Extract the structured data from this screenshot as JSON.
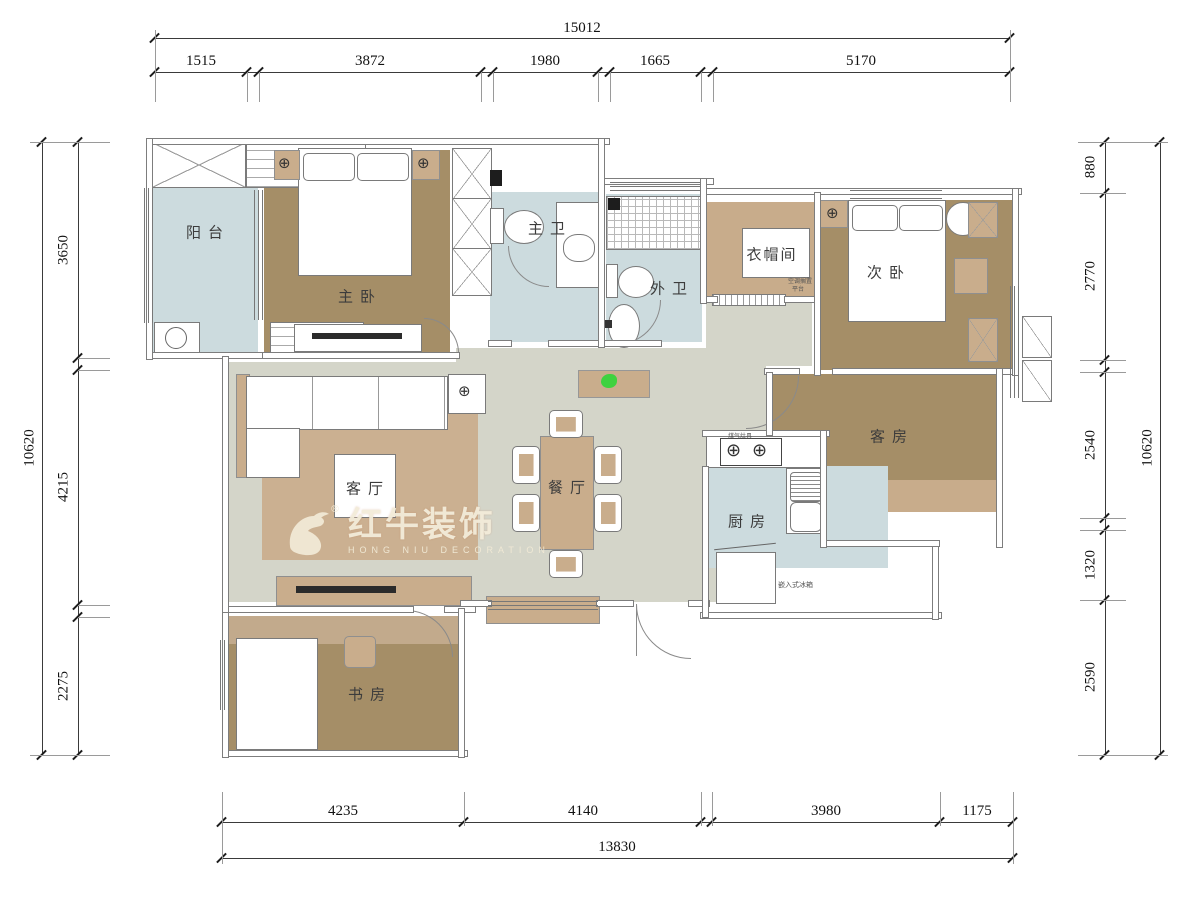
{
  "rooms": {
    "balcony": "阳台",
    "master_bedroom": "主卧",
    "master_bath": "主卫",
    "guest_bath": "外卫",
    "cloakroom": "衣帽间",
    "second_bedroom": "次卧",
    "living": "客厅",
    "dining": "餐厅",
    "guest_room": "客房",
    "kitchen": "厨房",
    "study": "书房"
  },
  "annotations": {
    "stove": "煤气灶具",
    "fridge": "嵌入式冰箱",
    "ac_shelf_line1": "空调搁置",
    "ac_shelf_line2": "平台"
  },
  "icons": {
    "target": "⊕",
    "registered": "®"
  },
  "dimensions": {
    "top": {
      "overall": "15012",
      "segments": [
        "1515",
        "3872",
        "1980",
        "1665",
        "5170"
      ]
    },
    "bottom": {
      "overall": "13830",
      "segments": [
        "4235",
        "4140",
        "3980",
        "1175"
      ]
    },
    "left": {
      "overall": "10620",
      "segments": [
        "3650",
        "4215",
        "2275"
      ]
    },
    "right": {
      "overall": "10620",
      "segments": [
        "880",
        "2770",
        "2540",
        "1320",
        "2590"
      ]
    }
  },
  "watermark": {
    "brand": "红牛装饰",
    "subtitle": "HONG NIU DECORATION"
  },
  "colors": {
    "floor_wood": "#a58e67",
    "floor_tan": "#c8ac8b",
    "floor_tile": "#ccdbde",
    "floor_hall": "#d4d5c9",
    "rug": "#cbb091",
    "accent_green": "#3fd23f",
    "watermark_cream": "#f3ecd9"
  }
}
